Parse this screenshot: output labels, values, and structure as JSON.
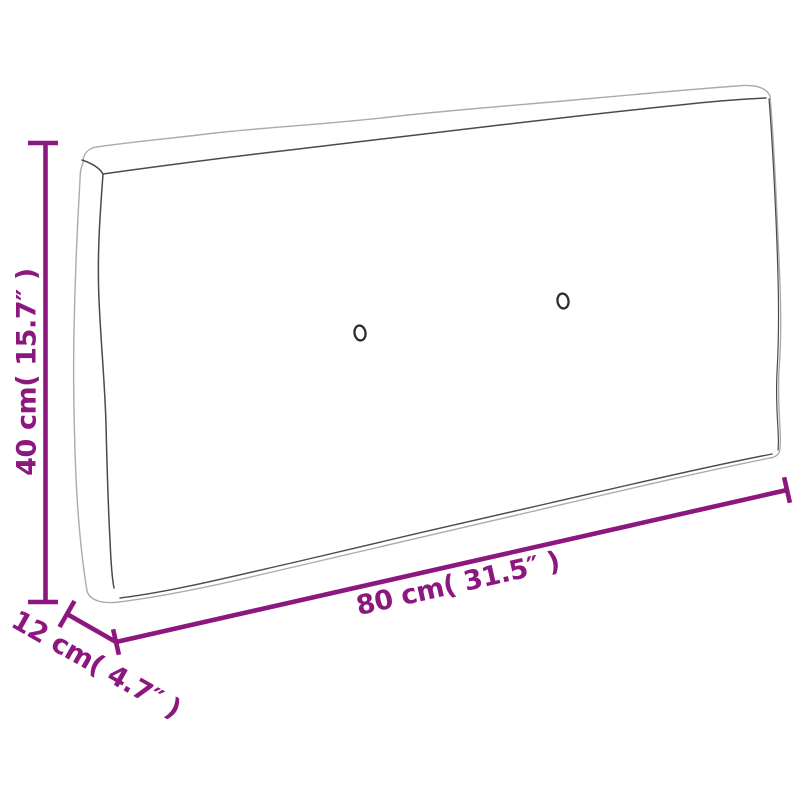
{
  "figure": {
    "type": "product-dimension-diagram",
    "subject": "pallet-cushion",
    "background": "#ffffff",
    "colors": {
      "dimension": "#8C177E",
      "outline_light": "#ABABAB",
      "outline_dark": "#4A4A4A",
      "button": "#2E2E2E"
    },
    "dimensions": {
      "height": {
        "label": "40 cm( 15.7″ )",
        "value_cm": 40,
        "value_in": 15.7
      },
      "length": {
        "label": "80 cm( 31.5″ )",
        "value_cm": 80,
        "value_in": 31.5
      },
      "depth": {
        "label": "12 cm( 4.7″ )",
        "value_cm": 12,
        "value_in": 4.7
      }
    }
  }
}
